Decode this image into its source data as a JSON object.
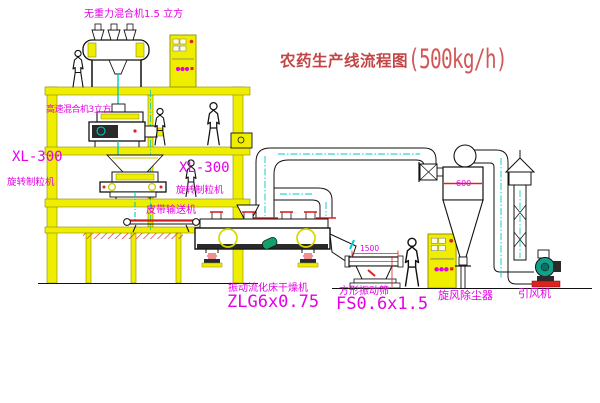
{
  "title": {
    "name": "农药生产线流程图",
    "capacity": "(500kg/h)"
  },
  "labels": {
    "gravity_mixer": "无重力混合机1.5 立方",
    "high_speed_mixer": "高速混合机3立方",
    "granulator_model_1": "XL-300",
    "granulator_name_1": "旋转制粒机",
    "granulator_model_2": "XL-300",
    "granulator_name_2": "旋转制粒机",
    "belt_conveyor": "皮带输送机",
    "dryer_name": "振动流化床干燥机",
    "dryer_model": "ZLG6x0.75",
    "screen_name": "方形振动筛",
    "screen_model": "FS0.6x1.5",
    "cyclone": "旋风除尘器",
    "fan": "引风机",
    "cyclone_dim": "600",
    "screen_dim": "1500"
  },
  "colors": {
    "structure_yellow": "#f0ee00",
    "pipe_cyan": "#00c8c8",
    "label_magenta": "#e400e4",
    "title_red": "#c34545",
    "detail_red": "#dd2222",
    "motor_green": "#12a08a"
  }
}
